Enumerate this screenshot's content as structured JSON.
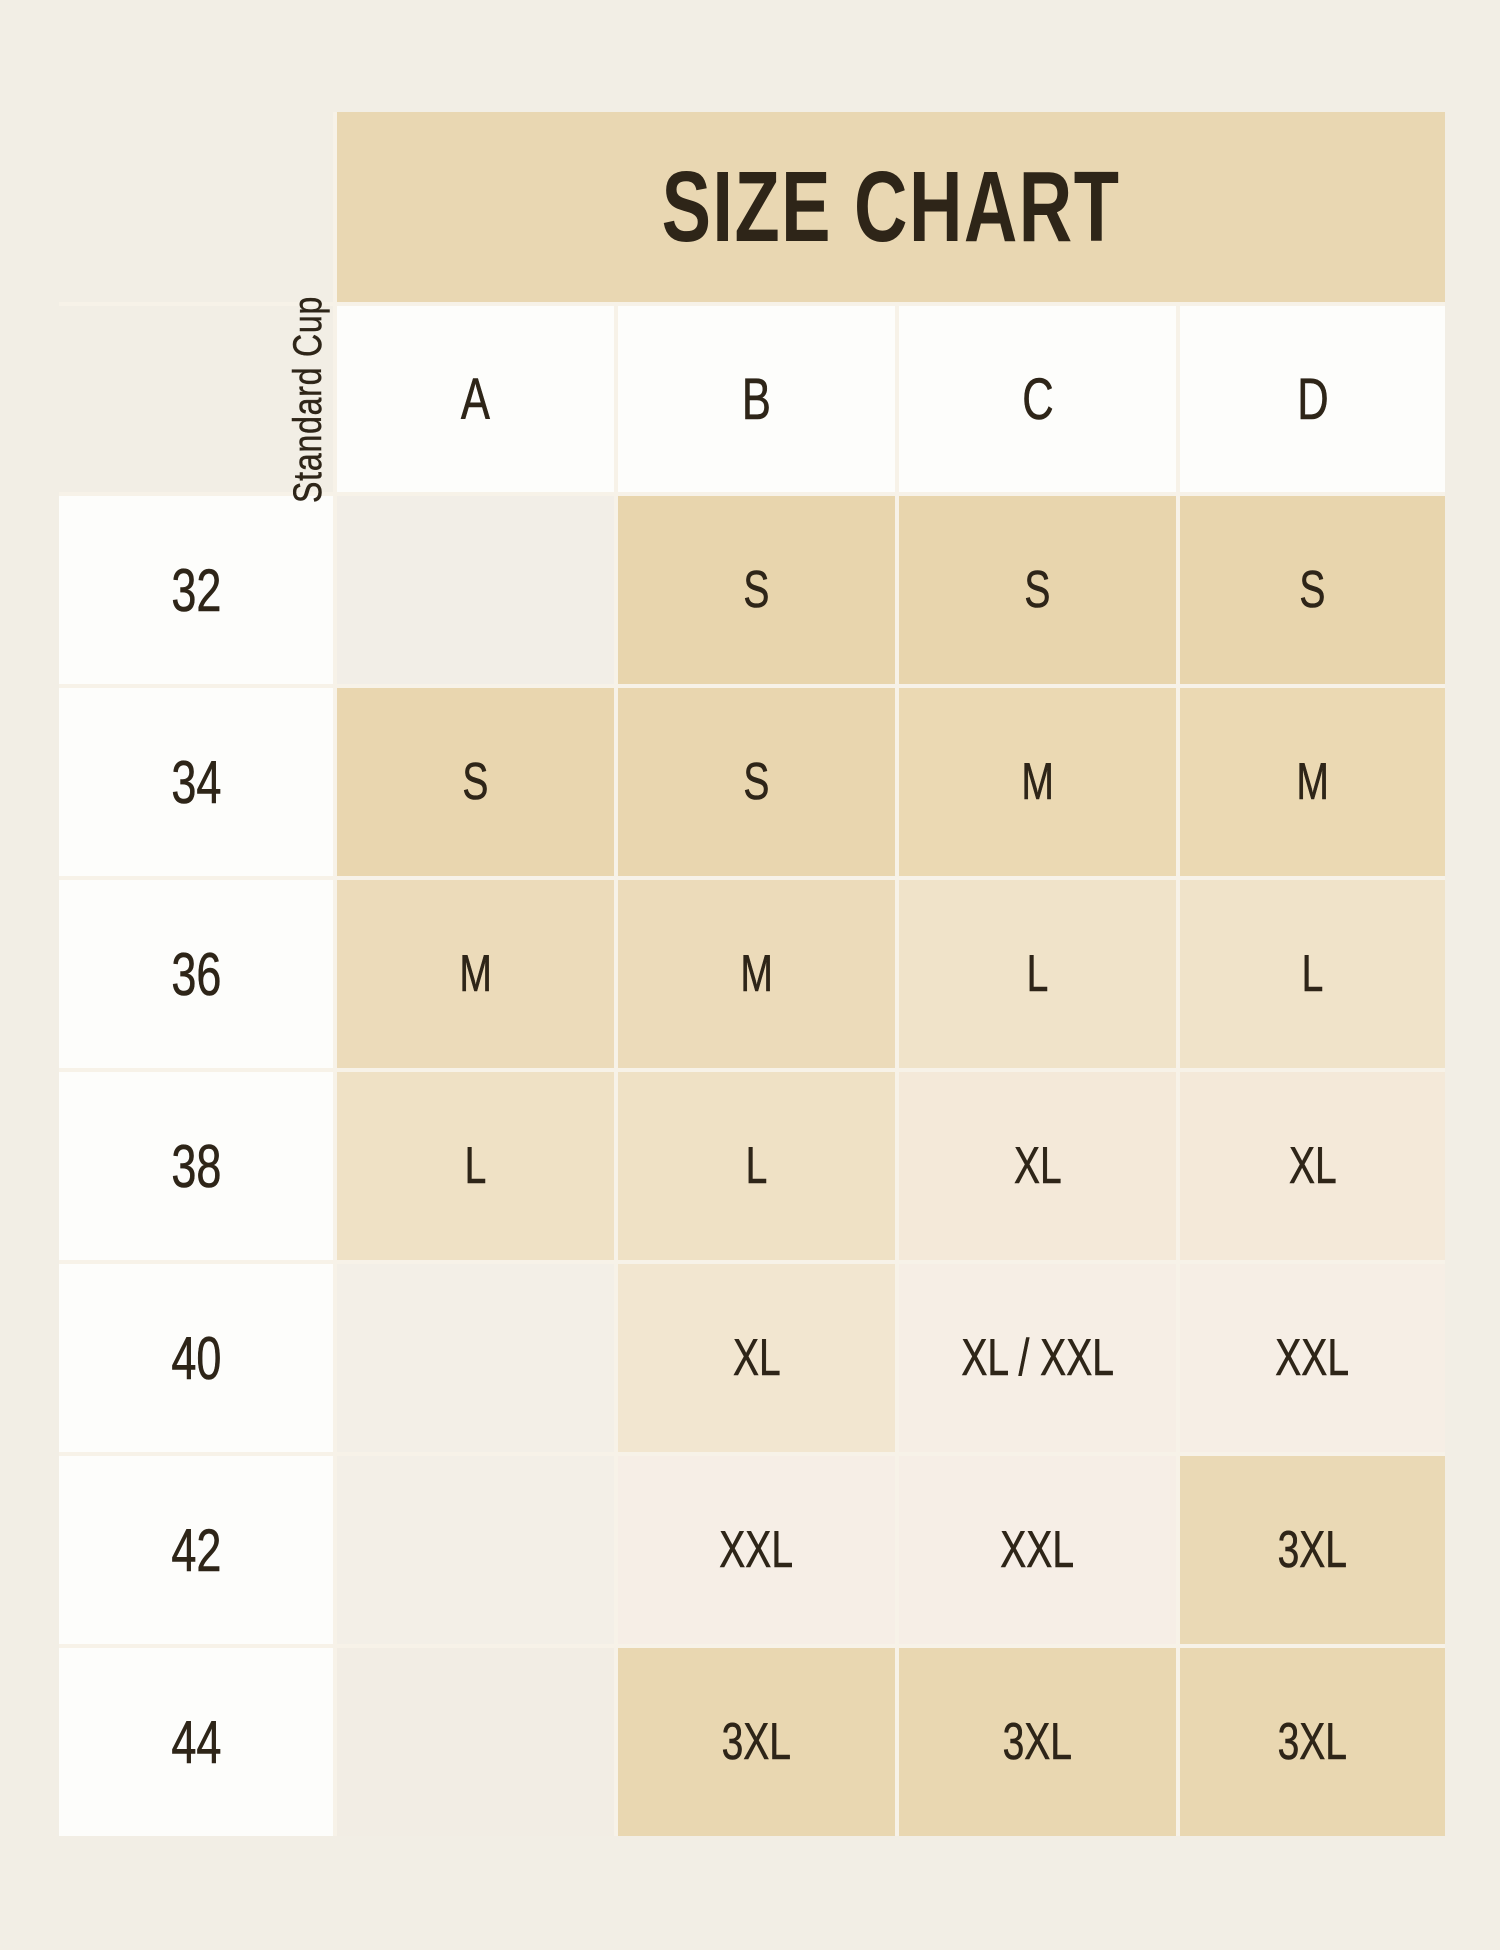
{
  "page": {
    "background": "#f2eee5",
    "text_color": "#2e2518"
  },
  "title": {
    "label": "SIZE CHART",
    "band_color": "#e9d7b2"
  },
  "header": {
    "axis_label": "Standard Cup",
    "columns": [
      "A",
      "B",
      "C",
      "D"
    ],
    "cell_bg": "#fdfdfb"
  },
  "table": {
    "gap_color": "#f7f2e8",
    "row_header_bg": "#fdfdfb",
    "rows": [
      {
        "band": "32",
        "cells": [
          {
            "text": "",
            "bg": "#f2eee7"
          },
          {
            "text": "S",
            "bg": "#e8d5ad"
          },
          {
            "text": "S",
            "bg": "#e8d5ad"
          },
          {
            "text": "S",
            "bg": "#e8d5ad"
          }
        ]
      },
      {
        "band": "34",
        "cells": [
          {
            "text": "S",
            "bg": "#e9d6af"
          },
          {
            "text": "S",
            "bg": "#e9d6af"
          },
          {
            "text": "M",
            "bg": "#ebd9b3"
          },
          {
            "text": "M",
            "bg": "#ebd9b3"
          }
        ]
      },
      {
        "band": "36",
        "cells": [
          {
            "text": "M",
            "bg": "#ecdbba"
          },
          {
            "text": "M",
            "bg": "#ecdbba"
          },
          {
            "text": "L",
            "bg": "#f0e3c9"
          },
          {
            "text": "L",
            "bg": "#f0e3c9"
          }
        ]
      },
      {
        "band": "38",
        "cells": [
          {
            "text": "L",
            "bg": "#efe1c5"
          },
          {
            "text": "L",
            "bg": "#efe1c5"
          },
          {
            "text": "XL",
            "bg": "#f4e9d9"
          },
          {
            "text": "XL",
            "bg": "#f4e9d9"
          }
        ]
      },
      {
        "band": "40",
        "cells": [
          {
            "text": "",
            "bg": "#f3efe7"
          },
          {
            "text": "XL",
            "bg": "#f2e6d0"
          },
          {
            "text": "XL / XXL",
            "bg": "#f6eee5"
          },
          {
            "text": "XXL",
            "bg": "#f6eee5"
          }
        ]
      },
      {
        "band": "42",
        "cells": [
          {
            "text": "",
            "bg": "#f3efe7"
          },
          {
            "text": "XXL",
            "bg": "#f6eee6"
          },
          {
            "text": "XXL",
            "bg": "#f6eee6"
          },
          {
            "text": "3XL",
            "bg": "#ead9b5"
          }
        ]
      },
      {
        "band": "44",
        "cells": [
          {
            "text": "",
            "bg": "#f2ede4"
          },
          {
            "text": "3XL",
            "bg": "#e9d7b1"
          },
          {
            "text": "3XL",
            "bg": "#e9d7b1"
          },
          {
            "text": "3XL",
            "bg": "#e9d7b1"
          }
        ]
      }
    ]
  },
  "chart_data": {
    "type": "table",
    "title": "SIZE CHART",
    "column_axis_label": "Standard Cup",
    "columns": [
      "A",
      "B",
      "C",
      "D"
    ],
    "row_labels": [
      "32",
      "34",
      "36",
      "38",
      "40",
      "42",
      "44"
    ],
    "values": [
      [
        "",
        "S",
        "S",
        "S"
      ],
      [
        "S",
        "S",
        "M",
        "M"
      ],
      [
        "M",
        "M",
        "L",
        "L"
      ],
      [
        "L",
        "L",
        "XL",
        "XL"
      ],
      [
        "",
        "XL",
        "XL / XXL",
        "XXL"
      ],
      [
        "",
        "XXL",
        "XXL",
        "3XL"
      ],
      [
        "",
        "3XL",
        "3XL",
        "3XL"
      ]
    ],
    "legend": "empty cell = size not offered for that band/cup combination"
  }
}
